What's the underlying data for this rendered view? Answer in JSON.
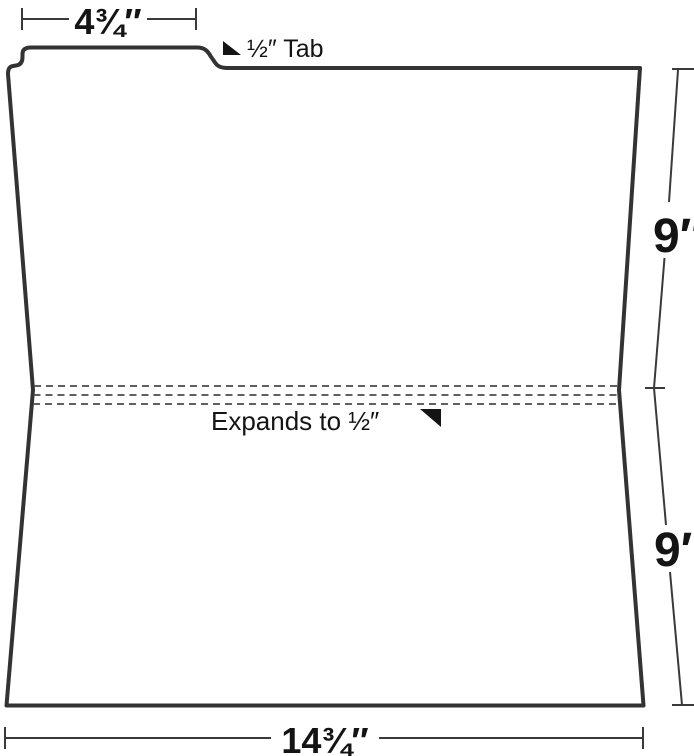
{
  "diagram": {
    "kind": "file-folder-dimension-diagram",
    "colors": {
      "ink": "#333333",
      "dimension_line": "#3a3a3a",
      "fold_line": "#4a4a4a",
      "text": "#141414",
      "background": "#ffffff"
    },
    "labels": {
      "tab_width": "4¾″",
      "tab": "½″ Tab",
      "upper_height": "9″",
      "expansion": "Expands to ½″",
      "lower_height": "9″",
      "bottom_width": "14¾″"
    },
    "icons": {
      "tab_pointer": "black-lower-left-triangle",
      "expansion_pointer": "black-upper-right-triangle"
    }
  }
}
